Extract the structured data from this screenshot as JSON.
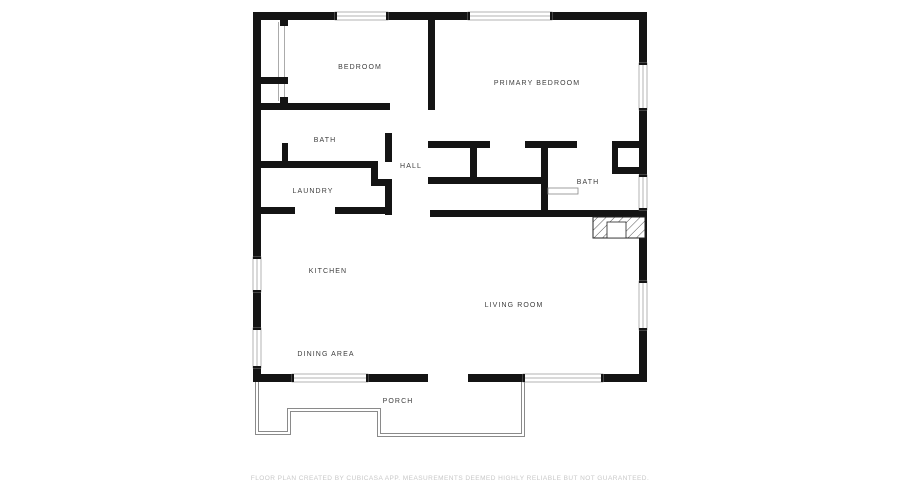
{
  "floor_plan": {
    "rooms": [
      {
        "id": "bedroom",
        "label": "BEDROOM"
      },
      {
        "id": "primary-bedroom",
        "label": "PRIMARY BEDROOM"
      },
      {
        "id": "bath-1",
        "label": "BATH"
      },
      {
        "id": "hall",
        "label": "HALL"
      },
      {
        "id": "laundry",
        "label": "LAUNDRY"
      },
      {
        "id": "bath-2",
        "label": "BATH"
      },
      {
        "id": "kitchen",
        "label": "KITCHEN"
      },
      {
        "id": "living-room",
        "label": "LIVING ROOM"
      },
      {
        "id": "dining-area",
        "label": "DINING AREA"
      },
      {
        "id": "porch",
        "label": "PORCH"
      }
    ],
    "footer_disclaimer": "FLOOR PLAN CREATED BY CUBICASA APP. MEASUREMENTS DEEMED HIGHLY RELIABLE BUT NOT GUARANTEED.",
    "colors": {
      "background": "#ffffff",
      "wall": "#141414",
      "label_text": "#3d3d3d",
      "footer_text": "#c8c8c8",
      "window_frame": "#9a9a9a",
      "porch_outline": "#8a8a8a"
    }
  }
}
